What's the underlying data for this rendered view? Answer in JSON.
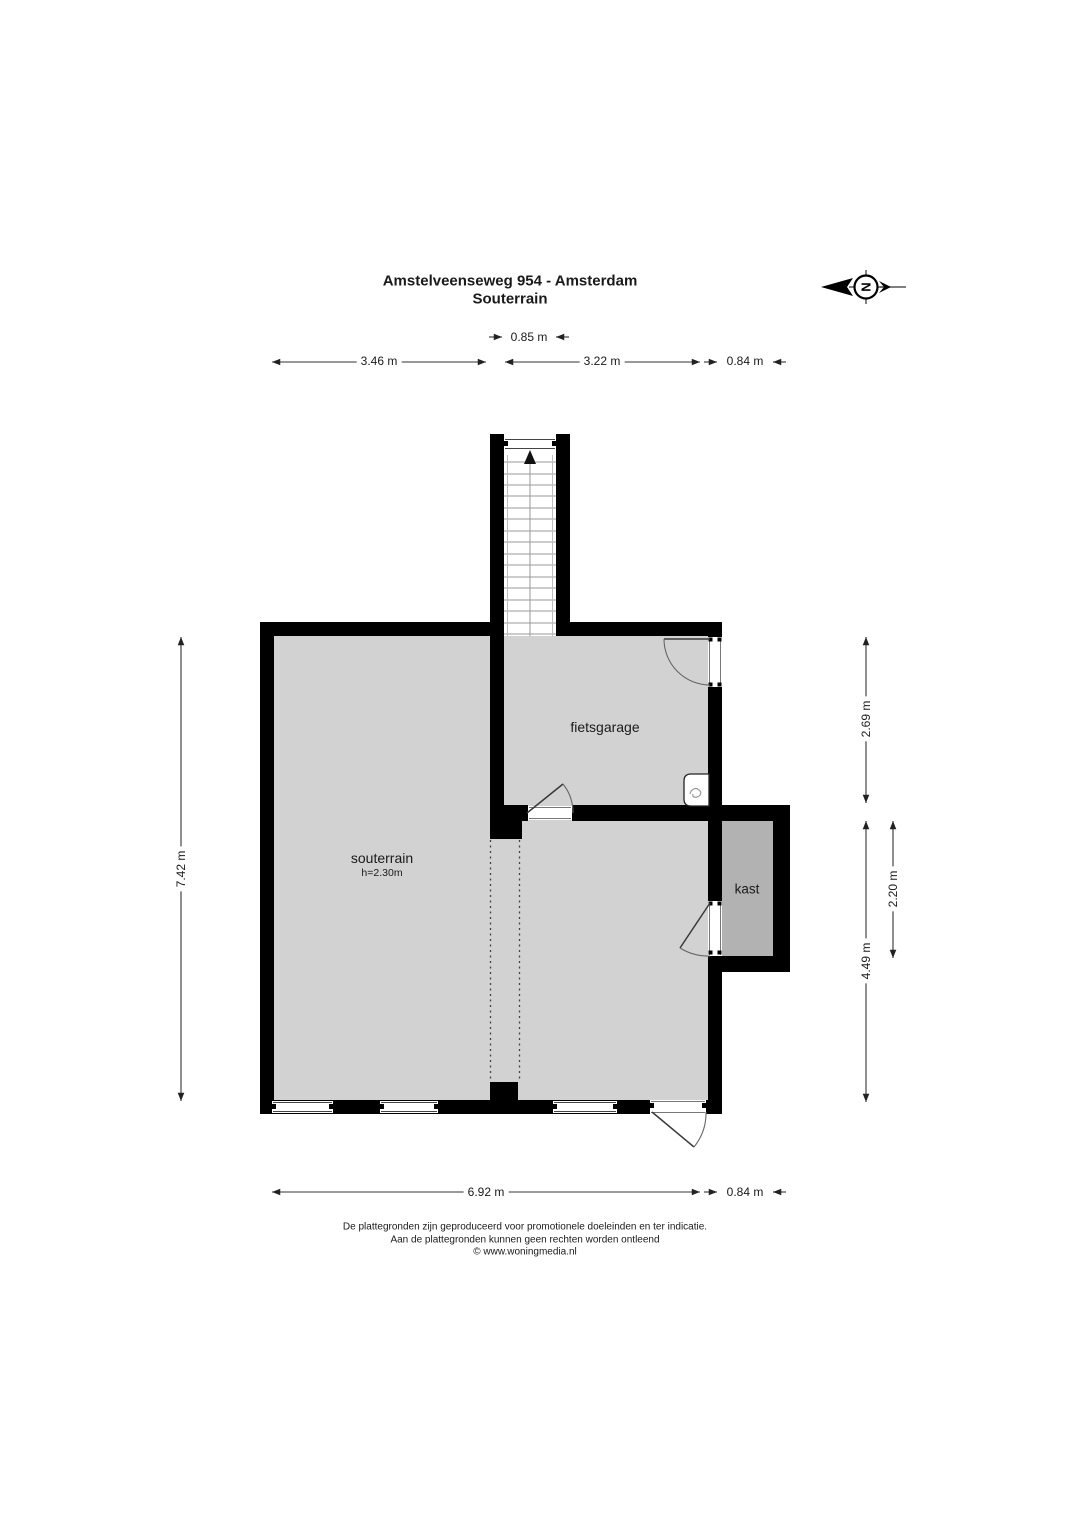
{
  "title": {
    "address": "Amstelveenseweg 954 - Amsterdam",
    "floor": "Souterrain"
  },
  "compass": {
    "north_letter": "N"
  },
  "dimensions": {
    "top_stair": "0.85 m",
    "top_left": "3.46 m",
    "top_right": "3.22 m",
    "top_kast": "0.84 m",
    "left_total": "7.42 m",
    "right_fietsgarage": "2.69 m",
    "right_lower": "4.49 m",
    "right_kast": "2.20 m",
    "bottom_main": "6.92 m",
    "bottom_kast": "0.84 m"
  },
  "rooms": {
    "souterrain_label": "souterrain",
    "souterrain_height": "h=2.30m",
    "fietsgarage_label": "fietsgarage",
    "kast_label": "kast"
  },
  "footer": {
    "line1": "De plattegronden zijn geproduceerd voor promotionele doeleinden en ter indicatie.",
    "line2": "Aan de plattegronden kunnen geen rechten worden ontleend",
    "line3": "© www.woningmedia.nl"
  },
  "colors": {
    "wall": "#000000",
    "floor": "#d2d2d2",
    "kast_floor": "#b2b2b2",
    "dim_line": "#333333",
    "text": "#1a1a1a"
  }
}
